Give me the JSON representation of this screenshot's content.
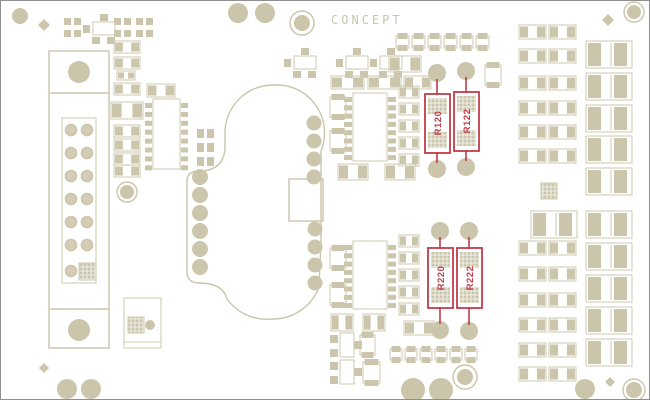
{
  "watermark": "CONCEPT",
  "colors": {
    "background": "#ffffff",
    "silkscreen": "#cbc5ab",
    "silkscreen_light": "#d2cdb4",
    "highlight": "#c03c49",
    "frame": "#8f8f8f"
  },
  "highlighted_components": [
    {
      "ref": "R120"
    },
    {
      "ref": "R122"
    },
    {
      "ref": "R220"
    },
    {
      "ref": "R222"
    }
  ]
}
